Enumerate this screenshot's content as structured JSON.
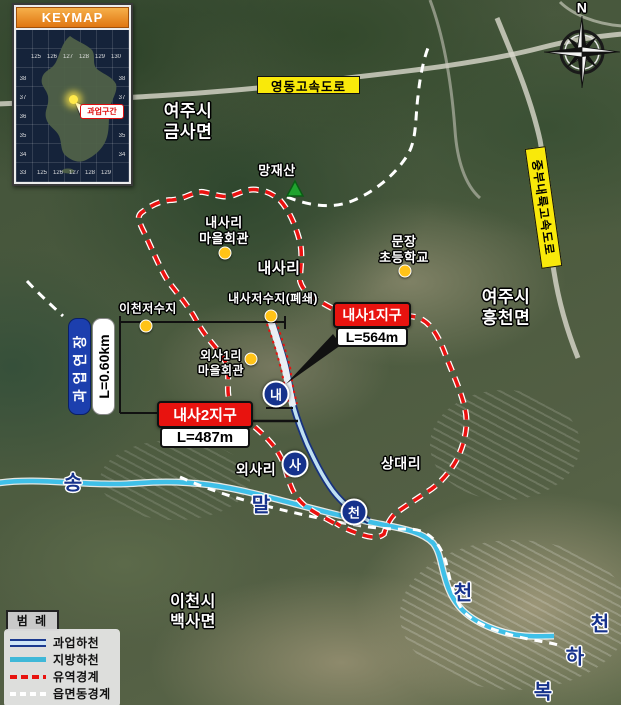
{
  "keymap": {
    "title": "KEYMAP",
    "marker_label": "과업구간",
    "lon_top": [
      "125",
      "126",
      "127",
      "128",
      "129",
      "130"
    ],
    "lon_bottom": [
      "125",
      "126",
      "127",
      "128",
      "129"
    ],
    "lat_left": [
      "38",
      "37",
      "36",
      "35",
      "34",
      "33"
    ],
    "lat_right": [
      "38",
      "37",
      "35",
      "34"
    ]
  },
  "compass": {
    "north_label": "N"
  },
  "highways": {
    "yeongdong": "영동고속도로",
    "jungbu_naeryuk": "중부내륙고속도로"
  },
  "project": {
    "extension_label": "과업연장",
    "extension_length": "L=0.60km",
    "district1_name": "내사1지구",
    "district1_length": "L=564m",
    "district2_name": "내사2지구",
    "district2_length": "L=487m"
  },
  "places": {
    "yeoju_geumsa": "여주시\n금사면",
    "mangjaesan": "망재산",
    "naesari_hall": "내사리\n마을회관",
    "naesari": "내사리",
    "munjang_school": "문장\n초등학교",
    "yeoju_heungcheon": "여주시\n흥천면",
    "icheon_reservoir": "이천저수지",
    "naesa_reservoir": "내사저수지(폐쇄)",
    "oesa1ri_hall": "외사1리\n마을회관",
    "oesari": "외사리",
    "sangdaeri": "상대리",
    "icheon_baeksa": "이천시\n백사면"
  },
  "river_chars": {
    "song": "송",
    "mal": "말",
    "cheon_songmal": "천",
    "nae": "내",
    "sa": "사",
    "cheon_naesa": "천",
    "cheon_bokha": "천",
    "ha": "하",
    "bok": "복"
  },
  "legend": {
    "title": "범 례",
    "items": [
      {
        "label": "과업하천"
      },
      {
        "label": "지방하천"
      },
      {
        "label": "유역경계"
      },
      {
        "label": "읍면동경계"
      }
    ]
  },
  "colors": {
    "highway_banner": "#f9e90a",
    "district_red": "#e8130f",
    "project_blue": "#1c3fae",
    "boundary_red": "#ea1210",
    "local_stream": "#3fc0e8",
    "marker_yellow": "#ffc318",
    "river_char_navy": "#16328c"
  }
}
